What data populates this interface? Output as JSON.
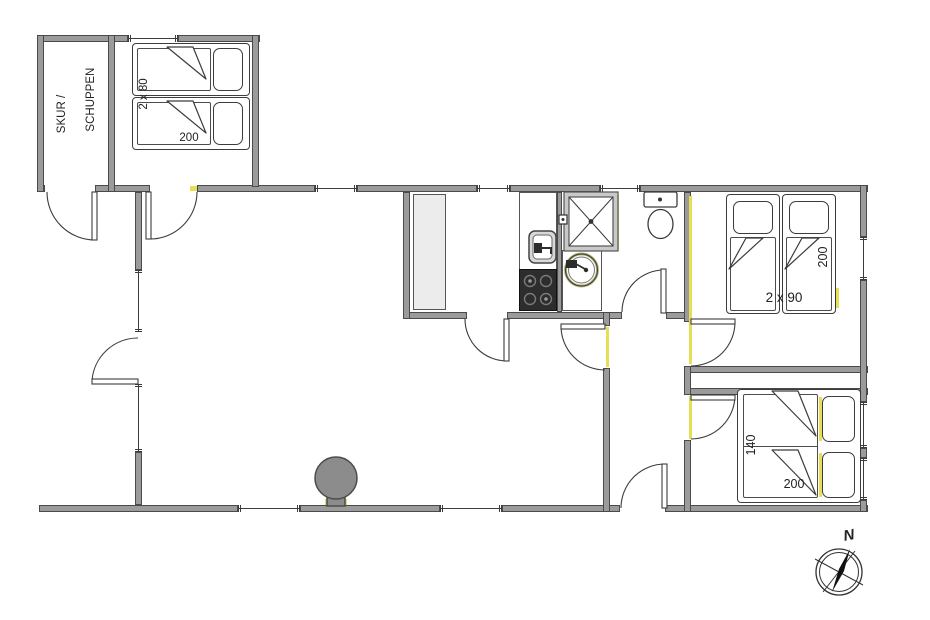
{
  "labels": {
    "shed_line1": "SKUR /",
    "shed_line2": "SCHUPPEN",
    "bedroom_nw_bed_width": "2 x 80",
    "bedroom_nw_bed_length": "200",
    "bedroom_east_bed_width": "2 x 90",
    "bedroom_east_bed_length": "200",
    "bedroom_se_bed_width": "140",
    "bedroom_se_bed_length": "200",
    "compass_north": "N"
  },
  "colors": {
    "wall": "#9b9b9b",
    "wall_outline": "#4a4a4a",
    "line": "#3c3c3c",
    "accent_yellow": "#e6df55",
    "counter_fill": "#ececec",
    "stove_fill": "#2d2d2d",
    "fireplace_fill": "#8c8c8c",
    "background": "#ffffff",
    "text": "#222222"
  },
  "icons": {
    "shower": "shower-cabin-icon",
    "washbasin": "washbasin-icon",
    "toilet": "toilet-icon",
    "kitchen_sink": "kitchen-sink-icon",
    "cooktop": "cooktop-icon",
    "fireplace": "fireplace-icon",
    "compass": "compass-north-icon"
  }
}
